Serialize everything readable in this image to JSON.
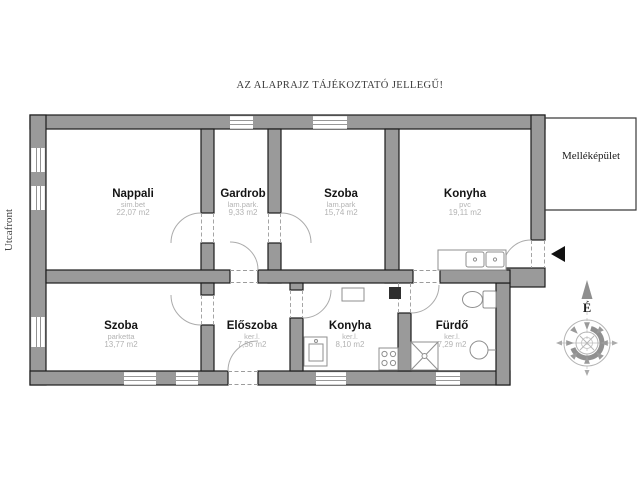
{
  "title": "AZ ALAPRAJZ TÁJÉKOZTATÓ JELLEGŰ!",
  "street_label": "Utcafront",
  "annex_label": "Melléképület",
  "compass": {
    "north_label": "É"
  },
  "rooms": [
    {
      "name": "Nappali",
      "floor": "sim.bet",
      "area": "22,07 m2"
    },
    {
      "name": "Gardrob",
      "floor": "lam.park.",
      "area": "9,33 m2"
    },
    {
      "name": "Szoba",
      "floor": "lam.park",
      "area": "15,74 m2"
    },
    {
      "name": "Konyha",
      "floor": "pvc",
      "area": "19,11 m2"
    },
    {
      "name": "Szoba",
      "floor": "parketta",
      "area": "13,77 m2"
    },
    {
      "name": "Előszoba",
      "floor": "ker.l.",
      "area": "7,56 m2"
    },
    {
      "name": "Konyha",
      "floor": "ker.l.",
      "area": "8,10 m2"
    },
    {
      "name": "Fürdő",
      "floor": "ker.l.",
      "area": "7,29 m2"
    }
  ],
  "colors": {
    "wall_fill": "#9a9a9a",
    "wall_stroke": "#1c1c1c",
    "muted_text": "#b3b3b3",
    "door_arc": "#ababab",
    "entrance_marker": "#111111"
  }
}
